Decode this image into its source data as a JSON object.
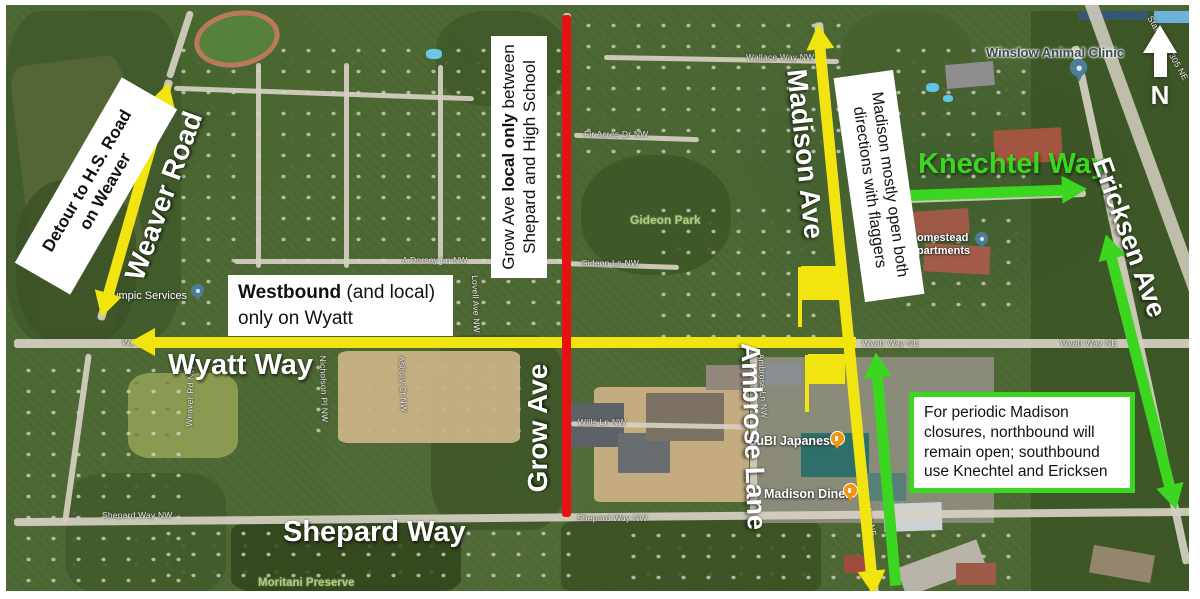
{
  "colors": {
    "arrow_yellow": "#f2e50f",
    "route_green": "#3bd61f",
    "closure_red": "#e81111"
  },
  "north": {
    "label": "N"
  },
  "notes": {
    "weaver_detour": {
      "line1": "Detour to H.S. Road",
      "line2": "on Weaver"
    },
    "wyatt": {
      "bold": "Westbound",
      "after": " (and local)",
      "line2": "only on Wyatt"
    },
    "grow": {
      "pre": "Grow Ave ",
      "bold": "local only",
      "post": " between",
      "line2": "Shepard and High School"
    },
    "madison": {
      "line1": "Madison mostly open both",
      "line2": "directions with flaggers"
    },
    "periodic": {
      "line1": "For periodic Madison",
      "line2": "closures, northbound will",
      "line3": "remain open; southbound",
      "line4": "use Knechtel and Ericksen"
    }
  },
  "roads": {
    "weaver": "Weaver Road",
    "wyatt": "Wyatt Way",
    "grow": "Grow Ave",
    "shepard": "Shepard Way",
    "madison": "Madison Ave",
    "ambrose": "Ambrose Lane",
    "knechtel": "Knechtel Way",
    "ericksen": "Ericksen Ave"
  },
  "streets": {
    "wallace": "Wallace Way NW",
    "fir_acres": "Fir Acres Dr NW",
    "gideon_ln": "Gideon Ln NW",
    "a_dorsey": "A Dorsey Ln NW",
    "wills": "Wills Ln NW",
    "shepard_nw_1": "Shepard Way NW",
    "shepard_nw_2": "Shepard Way NW",
    "wyatt_nw": "Wyatt Way NW",
    "wyatt_ne_1": "Wyatt Way NE",
    "wyatt_ne_2": "Wyatt Way NE",
    "hwy305": "State Hwy 305 NE",
    "madison_ne": "Madison Ave NE",
    "ambrose_nw": "Ambrose Ln NW",
    "weaver_nw": "Weaver Rd NW",
    "lovell": "Lovell Ave NW",
    "nicholson": "Nicholson Pl NW",
    "asbury": "Asbury Ct NW"
  },
  "pois": {
    "moritani": "Moritani Preserve",
    "gideon_park": "Gideon Park",
    "winslow_clinic": "Winslow Animal Clinic",
    "homestead_1": "Homestead",
    "homestead_2": "Apartments",
    "subi": "SuBI Japanese",
    "madison_diner": "Madison Diner",
    "olympic": "Olympic Services"
  }
}
